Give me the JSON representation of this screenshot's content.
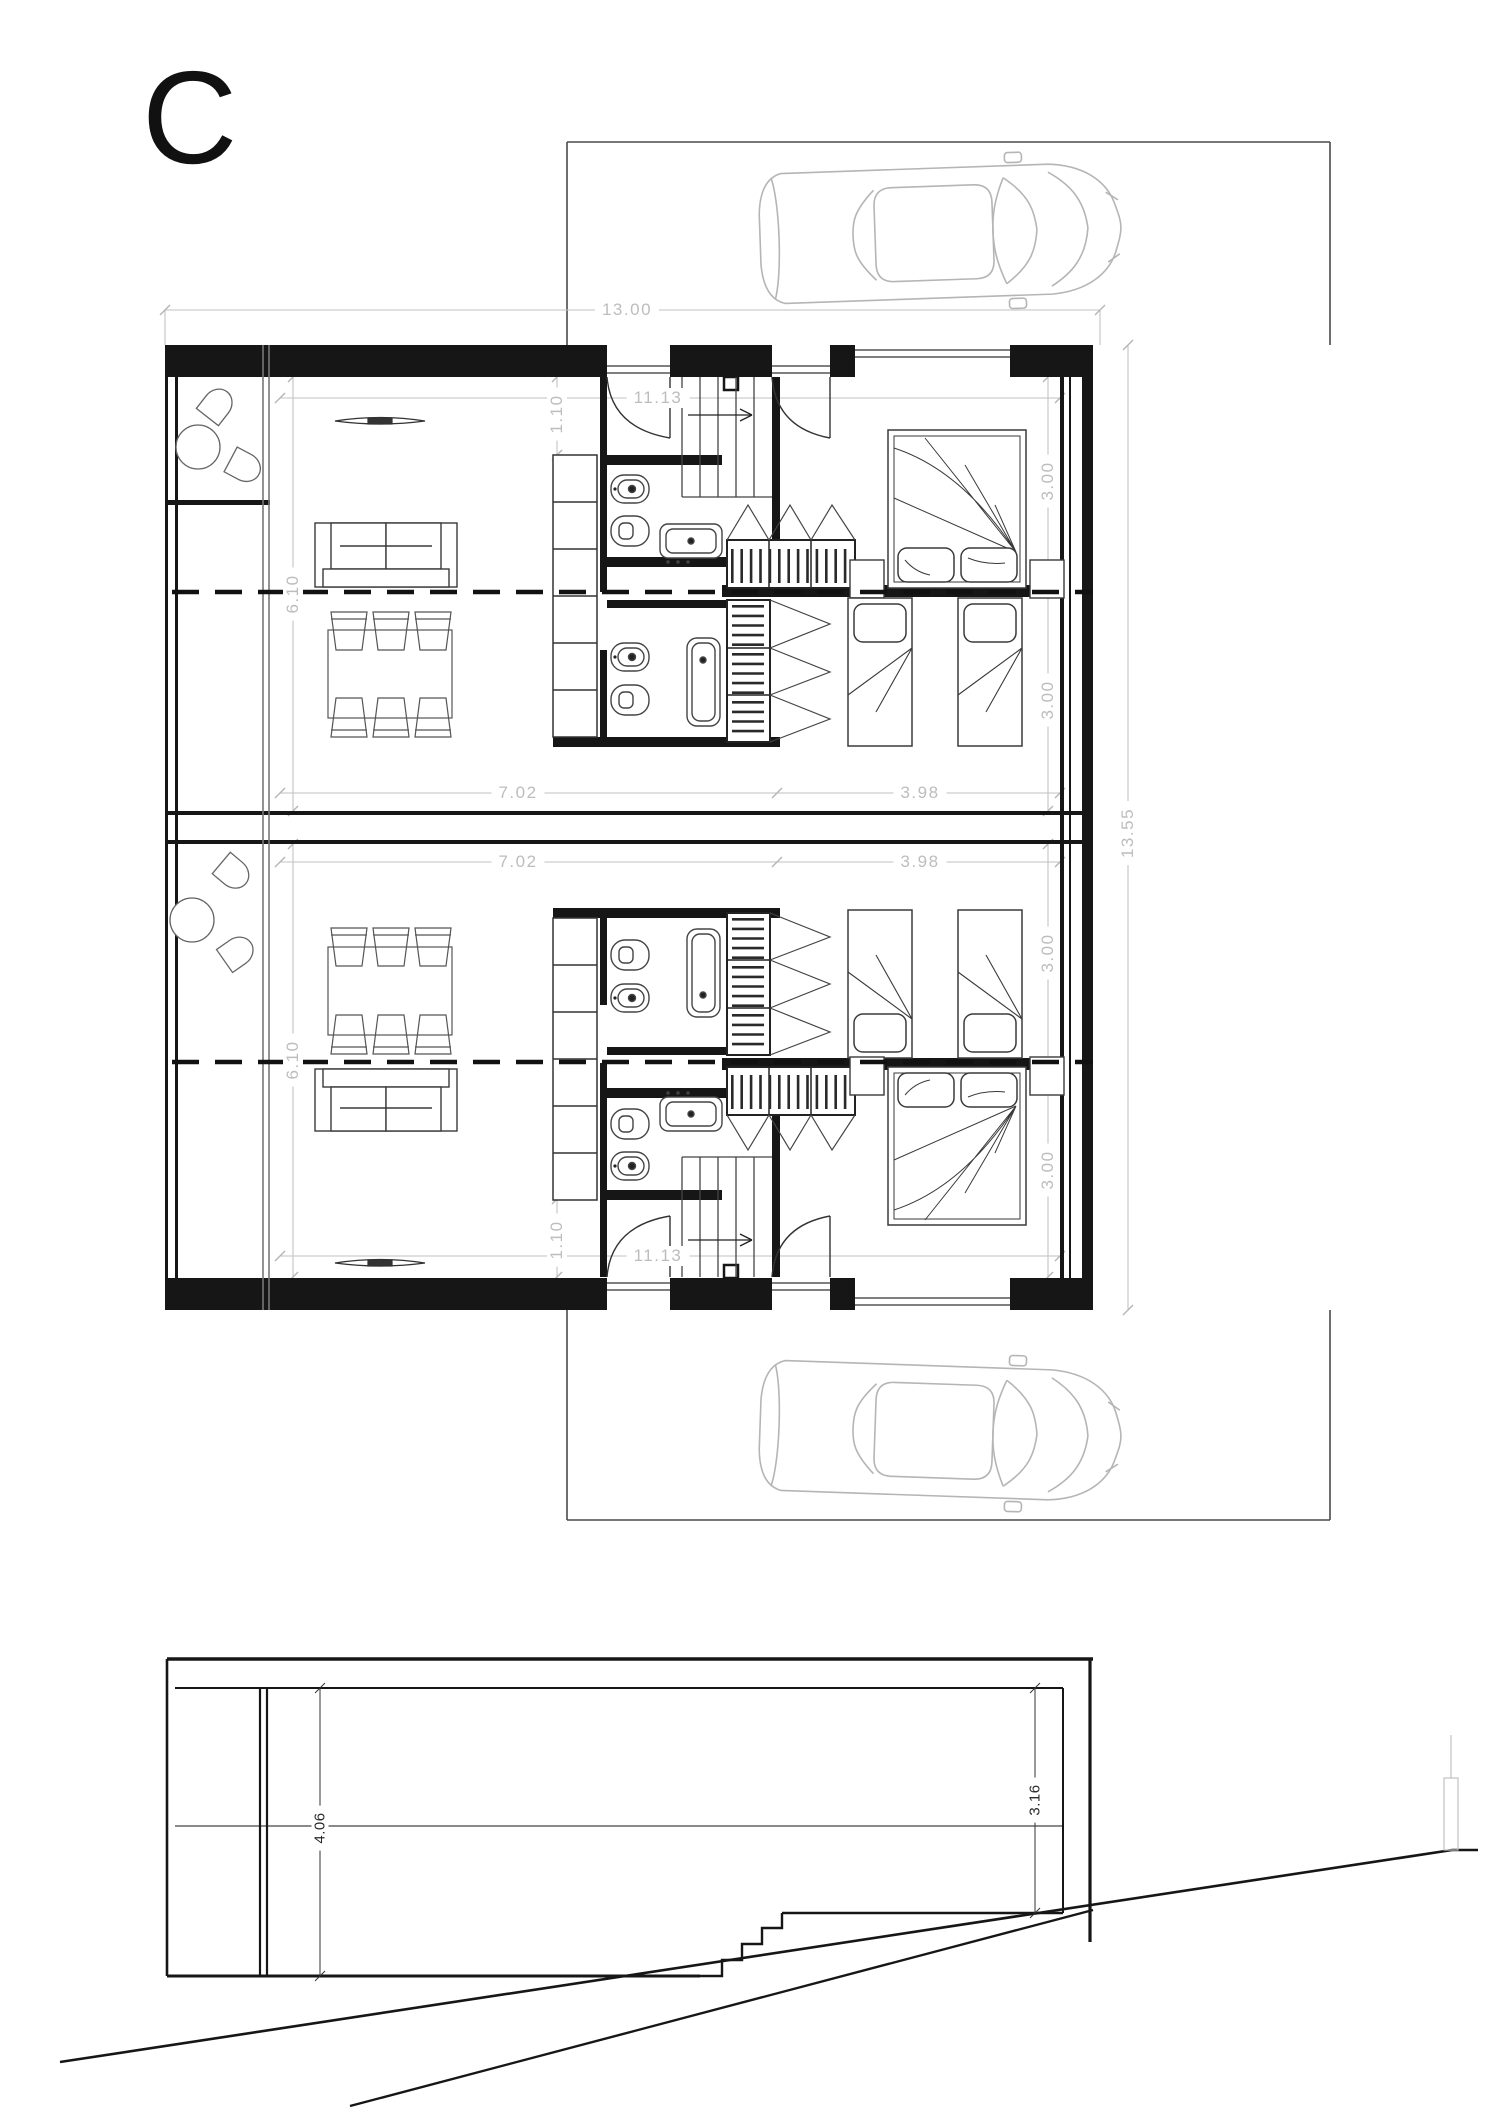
{
  "sheet": {
    "title": "C"
  },
  "plan": {
    "dimensions": {
      "overall_width": "13.00",
      "overall_depth": "13.55",
      "interior_width": "11.13",
      "living_room_width": "7.02",
      "bedroom_width": "3.98",
      "entry_depth": "1.10",
      "living_room_depth": "6.10",
      "bedroom_depth": "3.00"
    }
  },
  "section": {
    "dimensions": {
      "total_height": "4.06",
      "clear_height": "3.16"
    }
  },
  "colors": {
    "wall": "#161616",
    "furniture_line": "#3a3a3a",
    "dimension_line": "#c2c2c2",
    "car_line": "#b5b5b5"
  }
}
